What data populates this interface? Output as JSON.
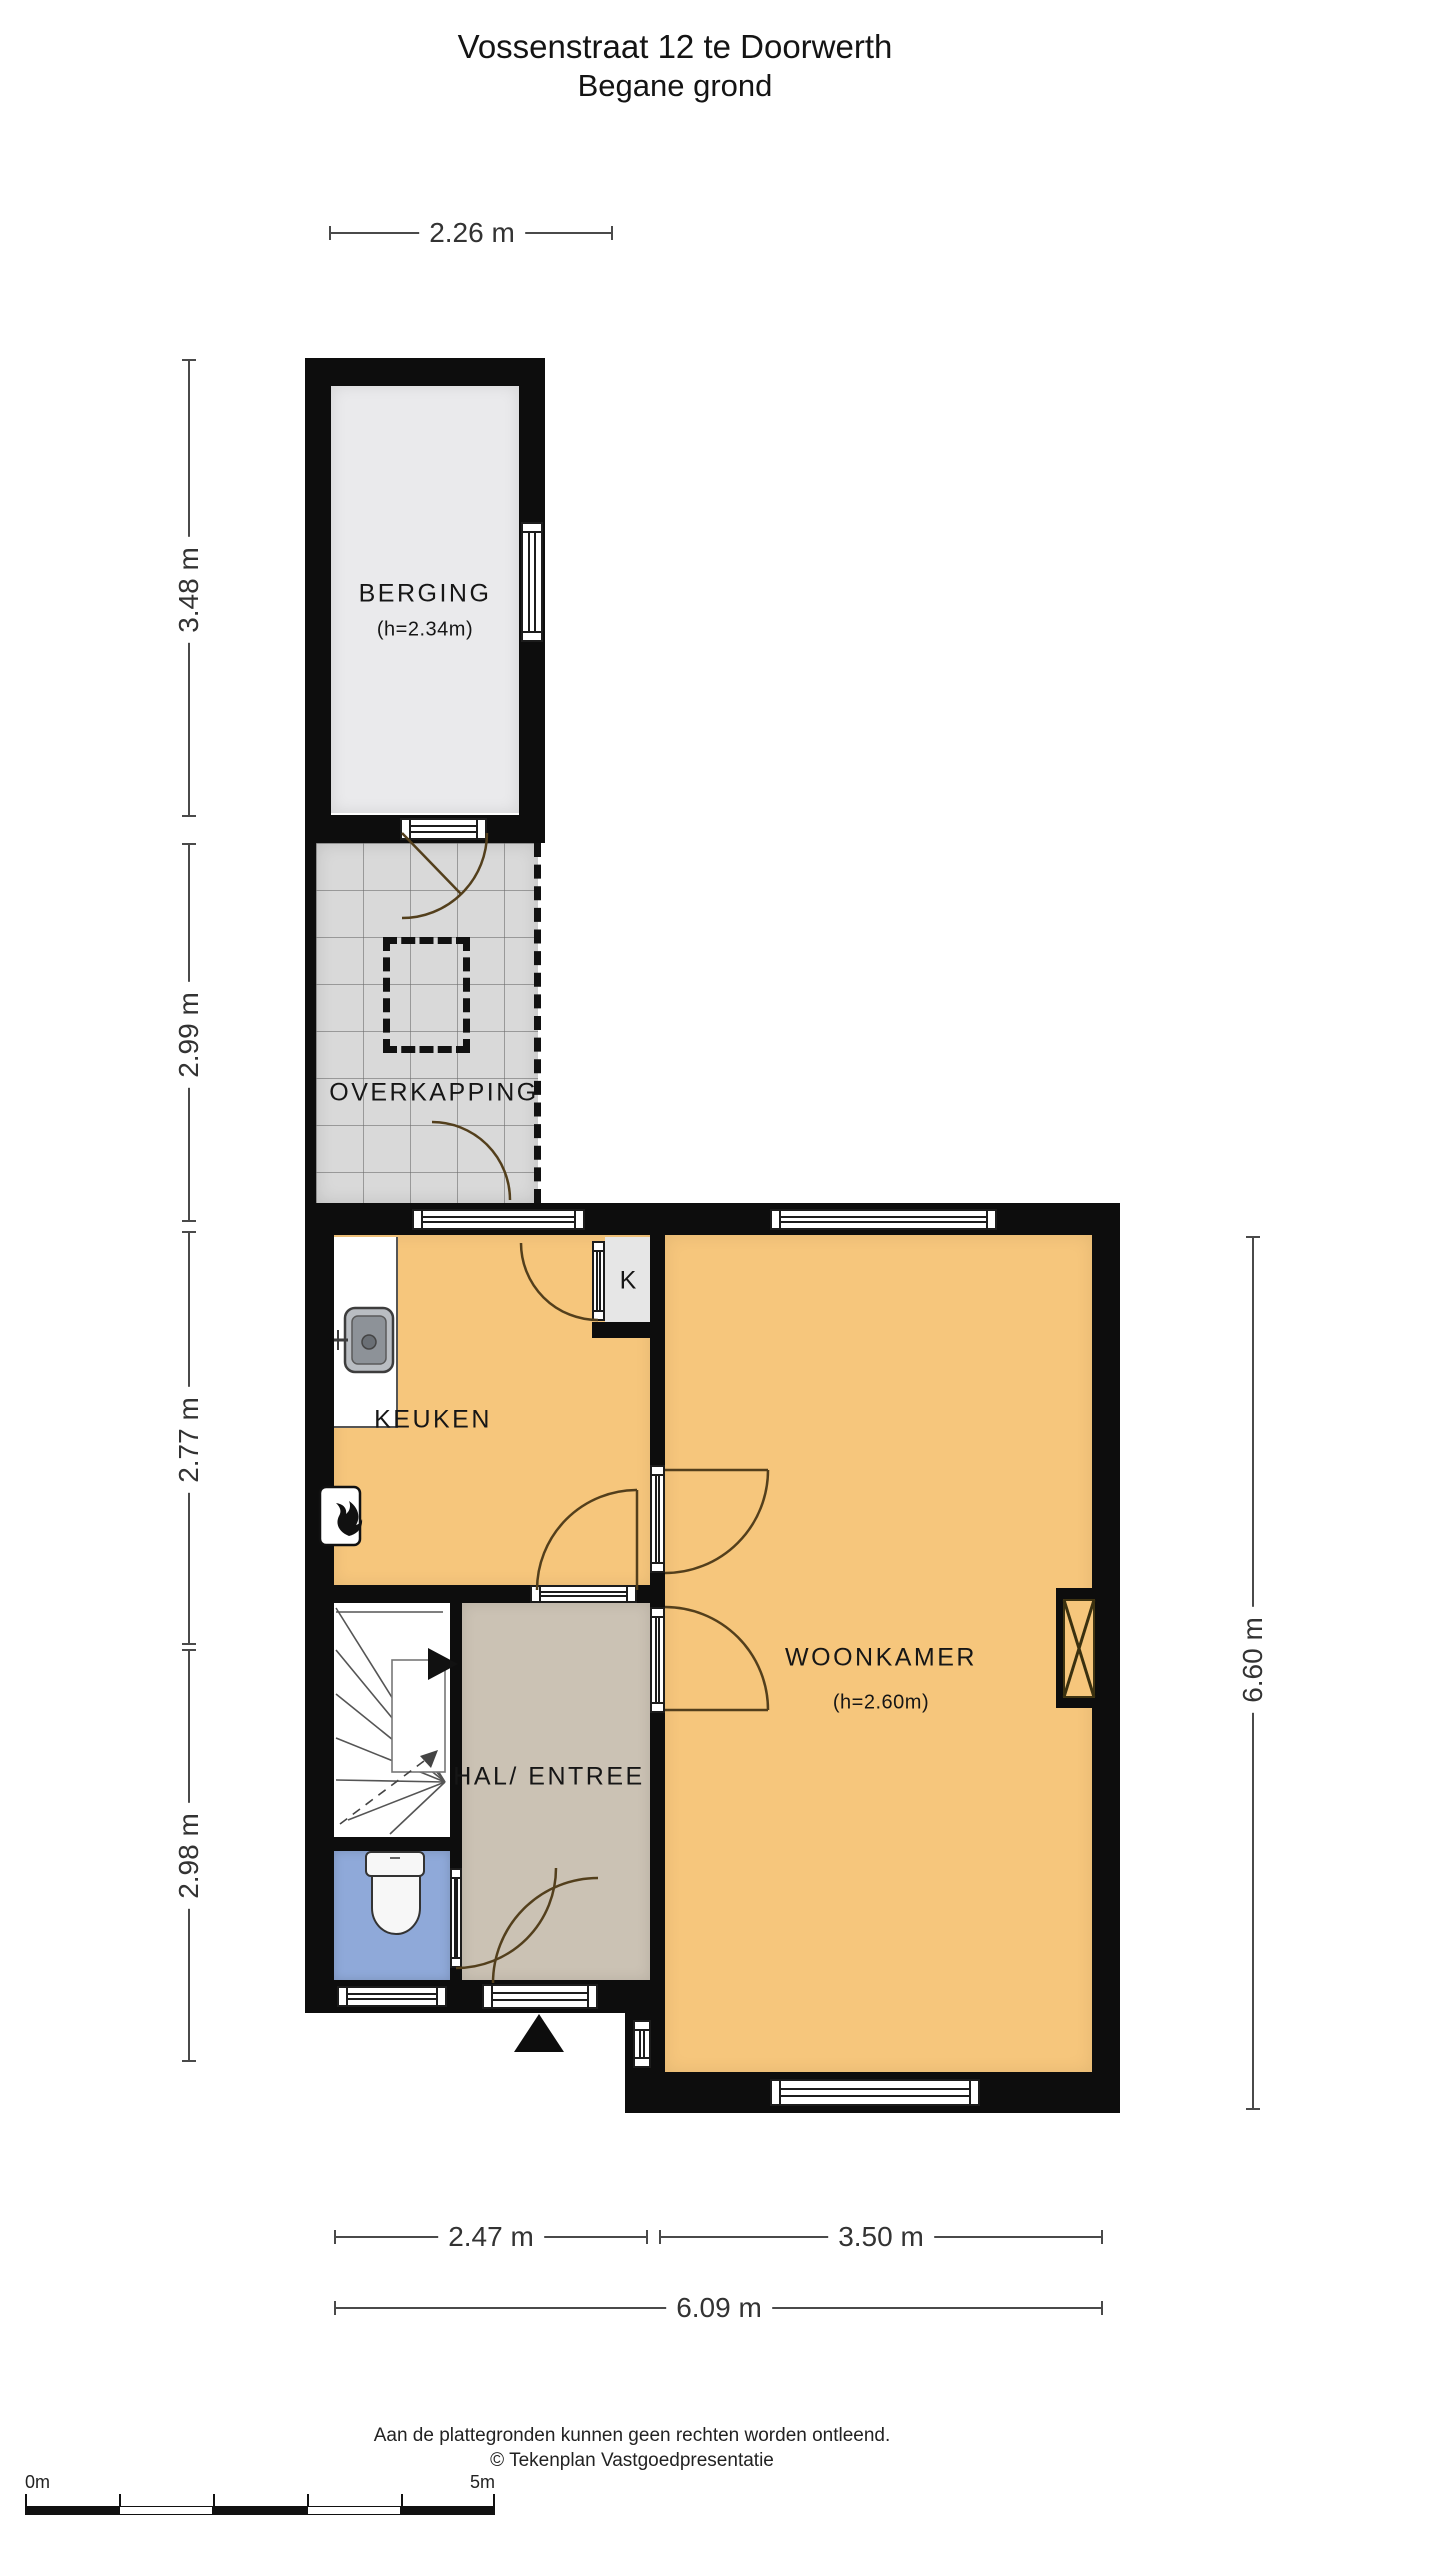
{
  "title": {
    "line1": "Vossenstraat 12 te Doorwerth",
    "line2": "Begane grond"
  },
  "rooms": {
    "berging": {
      "name": "BERGING",
      "height_note": "(h=2.34m)"
    },
    "overkapping": {
      "name": "OVERKAPPING"
    },
    "keuken": {
      "name": "KEUKEN"
    },
    "kast": {
      "name": "K"
    },
    "woonkamer": {
      "name": "WOONKAMER",
      "height_note": "(h=2.60m)"
    },
    "hal": {
      "name": "HAL/ ENTREE"
    }
  },
  "dimensions": {
    "top": "2.26 m",
    "left": [
      "3.48 m",
      "2.99 m",
      "2.77 m",
      "2.98 m"
    ],
    "right": "6.60 m",
    "bottom_row1": [
      "2.47 m",
      "3.50 m"
    ],
    "bottom_total": "6.09 m"
  },
  "scale_bar": {
    "start": "0m",
    "end": "5m"
  },
  "footer": {
    "line1": "Aan de plattegronden kunnen geen rechten worden ontleend.",
    "line2": "© Tekenplan Vastgoedpresentatie"
  },
  "colors": {
    "wall": "#0D0D0D",
    "floor_living": "#F6C67C",
    "floor_hall": "#CBC2B4",
    "floor_toilet": "#8FA9D9",
    "floor_storage": "#EAEAEC",
    "floor_tiles": "#D9D9D9",
    "floor_closet": "#E6E6E6"
  }
}
